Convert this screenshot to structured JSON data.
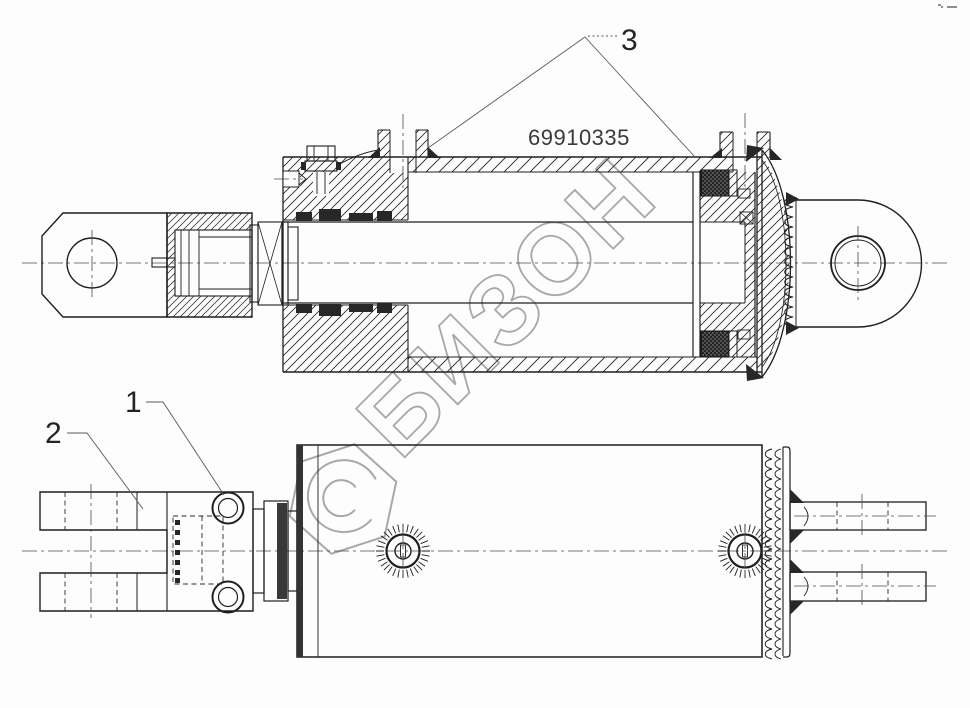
{
  "drawing": {
    "part_number": "69910335",
    "callouts": {
      "item1": "1",
      "item2": "2",
      "item3": "3"
    },
    "watermark": {
      "text": "БИЗОН"
    },
    "views": {
      "count": 2
    },
    "colors": {
      "line": "#1f1f1f",
      "centerline": "#4a4a4a",
      "watermark": "#a8a8a8",
      "part_number_text": "#3a3a3a",
      "background": "#fdfdfd",
      "seal_fill": "#272727"
    }
  }
}
